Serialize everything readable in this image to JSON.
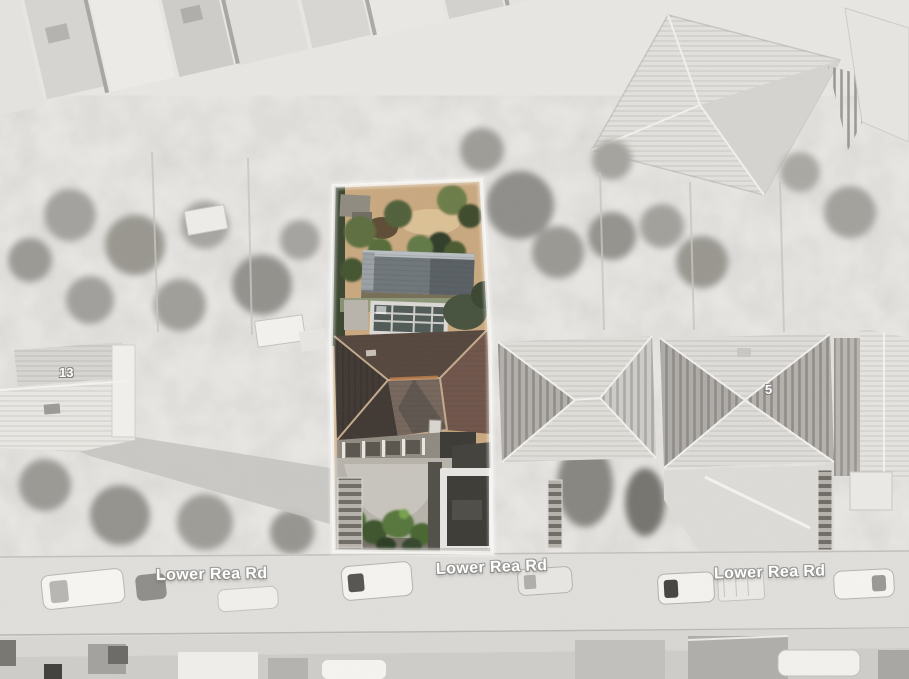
{
  "street_labels": [
    "Lower Rea Rd",
    "Lower Rea Rd",
    "Lower Rea Rd"
  ],
  "house_numbers": [
    "13",
    "5"
  ],
  "palette": {
    "background": "#e9e7e4",
    "road": "#e1dfdb",
    "label_text": "#ffffff",
    "label_outline": "#949491",
    "parcel_soil": "#c9a87e",
    "parcel_hedge": "#39442e",
    "parcel_foliage": "#55743a",
    "outbuilding_roof": "#6d757a",
    "conservatory_glass": "#4e5855",
    "roof_north": "#54453c",
    "roof_west": "#3f3631",
    "roof_east": "#6e5348",
    "roof_front": "#75655b",
    "ridge": "#c3aa8b",
    "ridge_highlight": "#bb7c46",
    "patio": "#c8c4bd",
    "garage_door": "#3a3934",
    "car_body": "#f7f5f1"
  }
}
